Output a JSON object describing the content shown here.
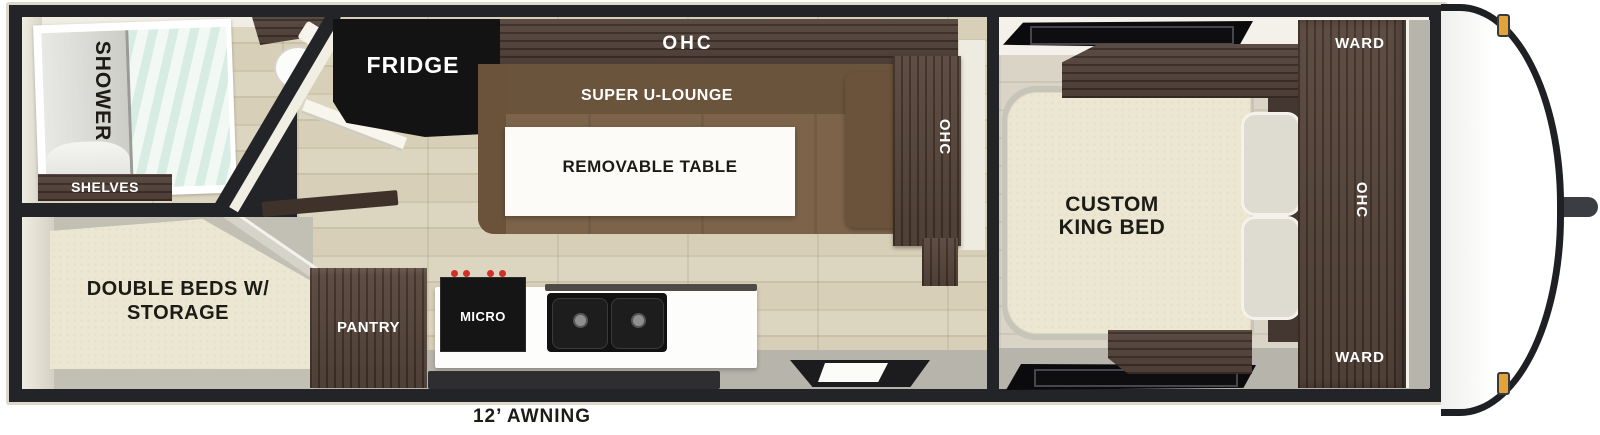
{
  "title": "travel trailer floorplan",
  "labels": {
    "shower": "SHOWER",
    "shelves": "SHELVES",
    "fridge": "FRIDGE",
    "ohc_galley": "OHC",
    "super_u_lounge": "SUPER U-LOUNGE",
    "removable_table": "REMOVABLE TABLE",
    "ohc_lounge_end": "OHC",
    "double_beds_line1": "DOUBLE BEDS W/",
    "double_beds_line2": "STORAGE",
    "pantry": "PANTRY",
    "micro": "MICRO",
    "king_bed_line1": "CUSTOM",
    "king_bed_line2": "KING BED",
    "ward_top": "WARD",
    "ohc_bedroom": "OHC",
    "ward_bottom": "WARD",
    "awning": "12’ AWNING"
  },
  "colors": {
    "walls": "#232428",
    "shell_trim": "#ddd8c9",
    "wood_floor": "#d7cfb7",
    "dark_cabinet": "#4a3a31",
    "lounge_brown": "#7c634a",
    "bed_cream": "#ece7d2",
    "appliance_black": "#141414",
    "burner_red": "#d03026",
    "marker_amber": "#e2a23c",
    "shower_glass": "#d7ece3"
  }
}
